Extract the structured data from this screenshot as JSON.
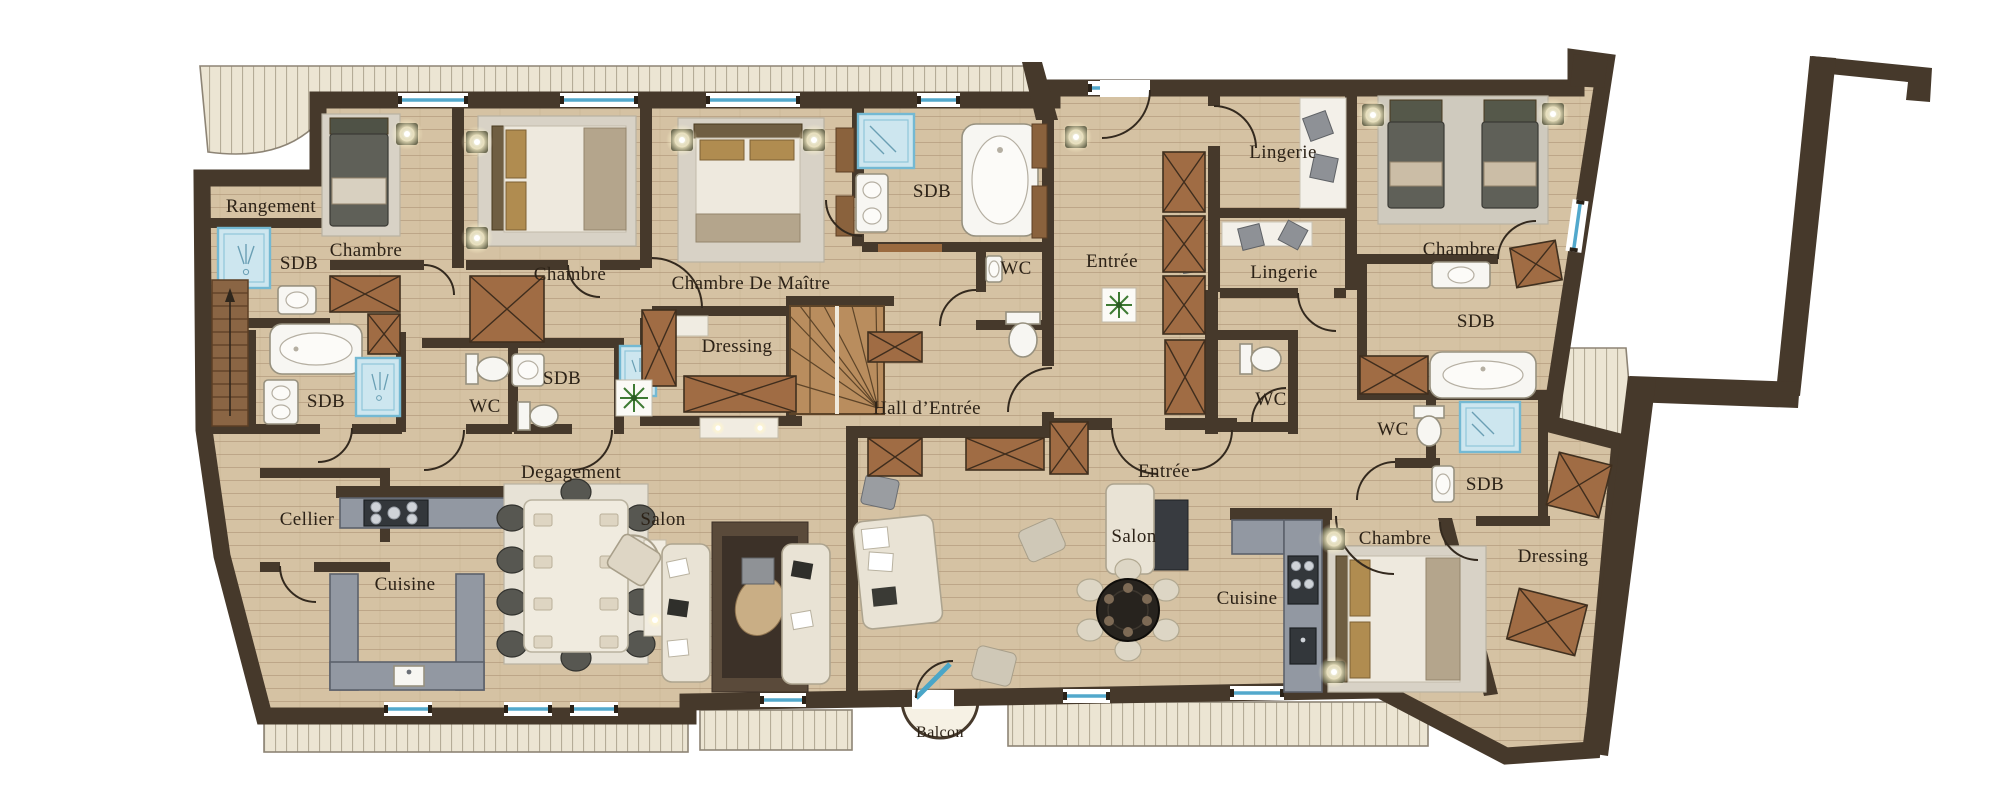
{
  "plan": {
    "rooms": [
      {
        "id": "rangement",
        "label": "Rangement"
      },
      {
        "id": "sdb-chambre-1",
        "label": "SDB"
      },
      {
        "id": "chambre-1",
        "label": "Chambre"
      },
      {
        "id": "chambre-2",
        "label": "Chambre"
      },
      {
        "id": "chambre-de-maitre",
        "label": "Chambre De Maître"
      },
      {
        "id": "sdb-maitre",
        "label": "SDB"
      },
      {
        "id": "wc-maitre",
        "label": "WC"
      },
      {
        "id": "dressing-maitre",
        "label": "Dressing"
      },
      {
        "id": "hall-entree",
        "label": "Hall d’Entrée"
      },
      {
        "id": "entree-apt2",
        "label": "Entrée"
      },
      {
        "id": "lingerie-1",
        "label": "Lingerie"
      },
      {
        "id": "lingerie-2",
        "label": "Lingerie"
      },
      {
        "id": "chambre-3",
        "label": "Chambre"
      },
      {
        "id": "sdb-chambre-3",
        "label": "SDB"
      },
      {
        "id": "sdb-gauche",
        "label": "SDB"
      },
      {
        "id": "wc-2",
        "label": "WC"
      },
      {
        "id": "sdb-5",
        "label": "SDB"
      },
      {
        "id": "degagement",
        "label": "Degagement"
      },
      {
        "id": "cellier",
        "label": "Cellier"
      },
      {
        "id": "cuisine-1",
        "label": "Cuisine"
      },
      {
        "id": "salon-1",
        "label": "Salon"
      },
      {
        "id": "entree-2",
        "label": "Entrée"
      },
      {
        "id": "salon-2",
        "label": "Salon"
      },
      {
        "id": "cuisine-2",
        "label": "Cuisine"
      },
      {
        "id": "wc-3",
        "label": "WC"
      },
      {
        "id": "wc-4",
        "label": "WC"
      },
      {
        "id": "sdb-6",
        "label": "SDB"
      },
      {
        "id": "chambre-4",
        "label": "Chambre"
      },
      {
        "id": "dressing-2",
        "label": "Dressing"
      },
      {
        "id": "balcon",
        "label": "Balcon"
      }
    ],
    "colors": {
      "background": "#ffffff",
      "wall": "#46392b",
      "wood_floor": "#d5c2a3",
      "wood_floor_line": "#aa9070",
      "tile_floor": "#dad6cb",
      "tile_large": "#e4e1d8",
      "deck": "#ece5d3",
      "window_accent": "#52a8cc",
      "shower": "#cde6ef",
      "closet_wood": "#a06c44",
      "stair_wood": "#b98d5e",
      "kitchen_counter": "#9298a2",
      "label_text": "#2c2217"
    }
  }
}
